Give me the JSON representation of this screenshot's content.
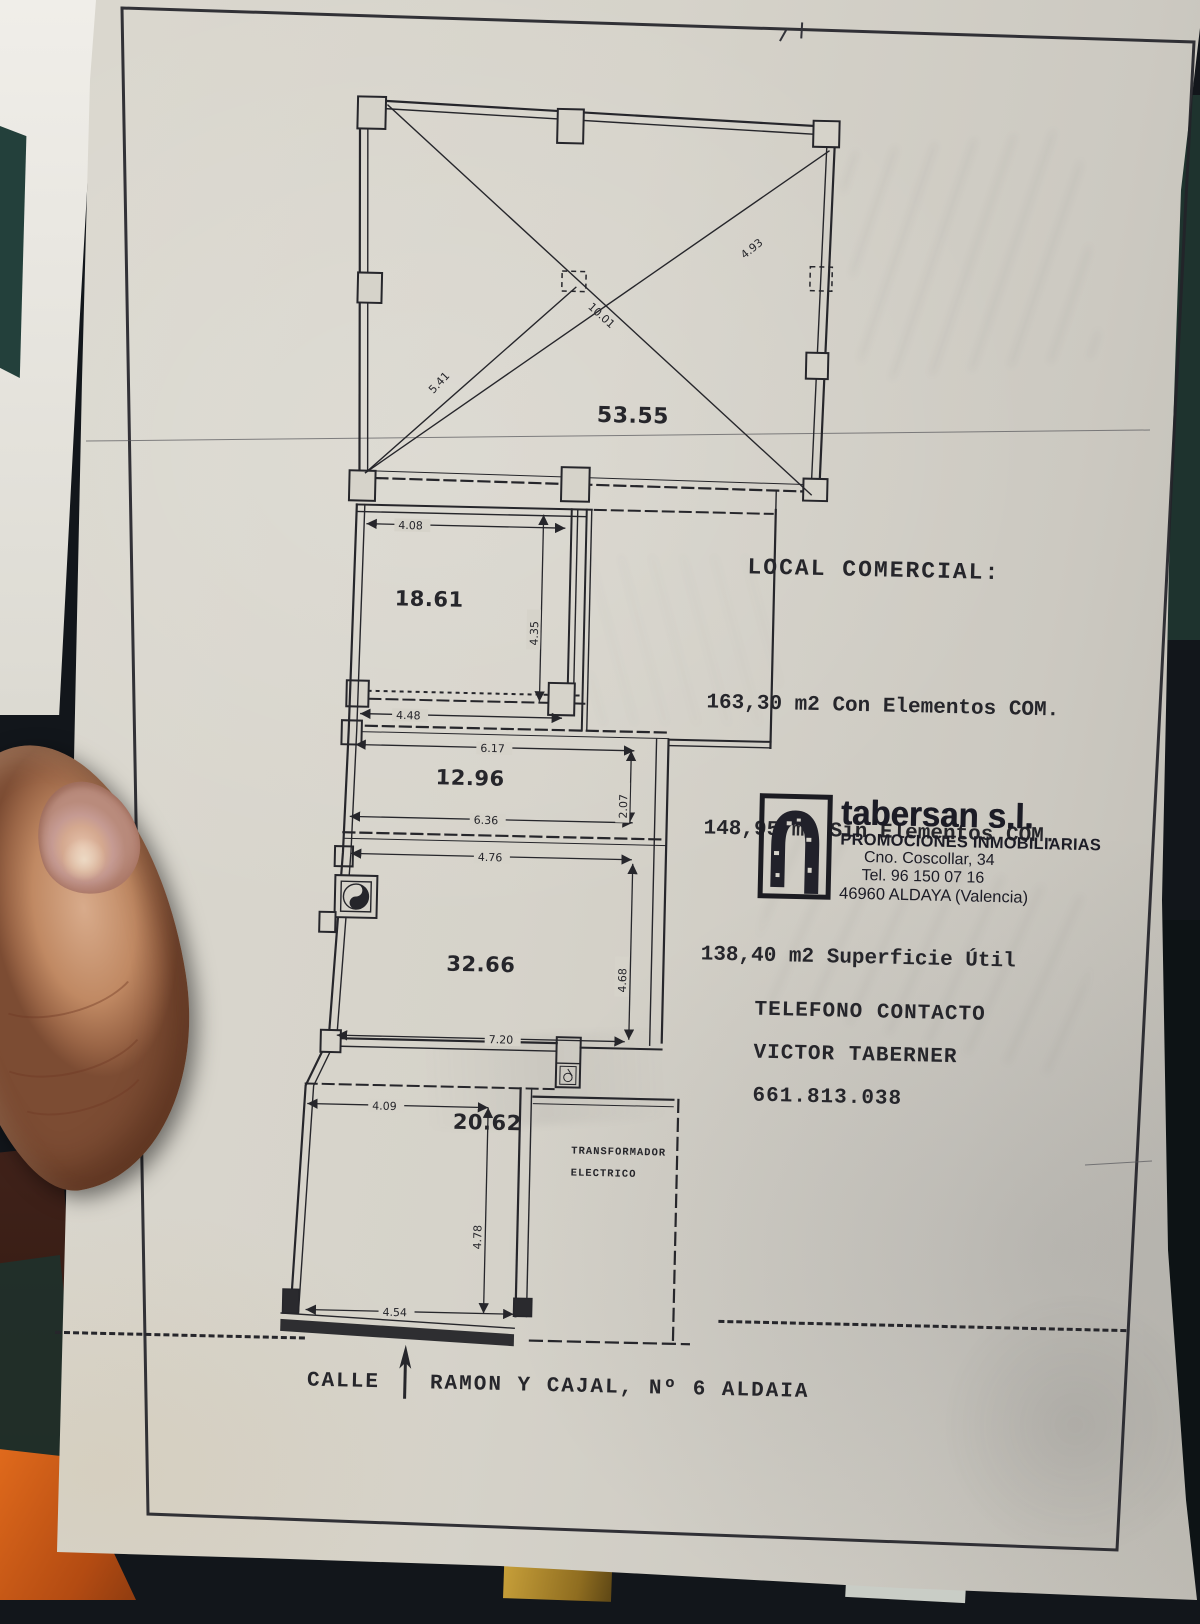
{
  "colors": {
    "paper": "#d6d3ca",
    "ink": "#26262b",
    "background": "#12161b",
    "orange_object": "#cf5c17",
    "teal_background": "#23403b",
    "gold_object": "#a8842c",
    "skin": "#c99a79"
  },
  "header": {
    "title": "LOCAL COMERCIAL:",
    "area_lines": [
      "163,30 m2 Con Elementos COM.",
      "148,95 m2 Sin Elementos COM.",
      "138,40 m2 Superficie Útil"
    ]
  },
  "stamp": {
    "company": "tabersan s.l.",
    "tagline": "PROMOCIONES INMOBILIARIAS",
    "address": "Cno. Coscollar, 34",
    "phone": "Tel. 96 150 07 16",
    "city": "46960 ALDAYA (Valencia)"
  },
  "contact": {
    "label": "TELEFONO CONTACTO",
    "name": "VICTOR TABERNER",
    "phone": "661.813.038"
  },
  "street": {
    "prefix": "CALLE",
    "name": "RAMON Y CAJAL, Nº 6 ALDAIA"
  },
  "plan": {
    "rooms": [
      {
        "area": "53.55"
      },
      {
        "area": "18.61"
      },
      {
        "area": "12.96"
      },
      {
        "area": "32.66"
      },
      {
        "area": "20.62"
      }
    ],
    "diagonals": [
      "5.41",
      "10.01",
      "4.93"
    ],
    "dims": {
      "d408": "4.08",
      "d435": "4.35",
      "d448": "4.48",
      "d617": "6.17",
      "d636": "6.36",
      "d207": "2.07",
      "d476": "4.76",
      "d720": "7.20",
      "d468": "4.68",
      "d409": "4.09",
      "d478": "4.78",
      "d454": "4.54"
    },
    "transformer": [
      "TRANSFORMADOR",
      "ELECTRICO"
    ]
  }
}
